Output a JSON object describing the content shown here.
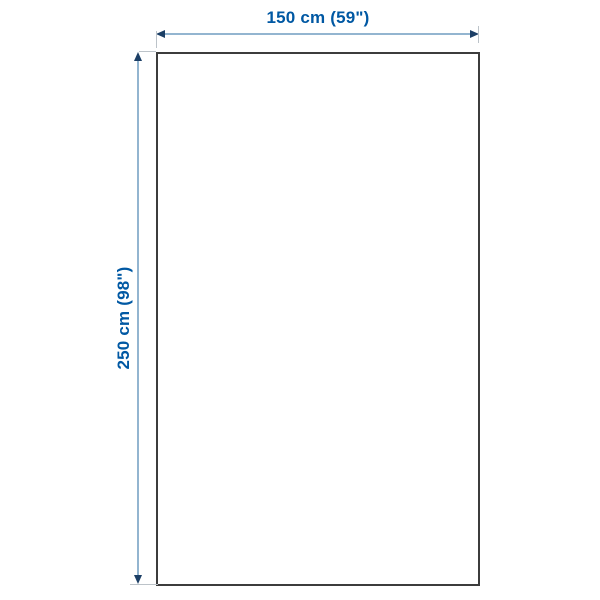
{
  "diagram": {
    "type": "product-dimension-diagram",
    "width_label": "150 cm (59\")",
    "height_label": "250 cm (98\")",
    "width_cm": 150,
    "width_in": 59,
    "height_cm": 250,
    "height_in": 98
  },
  "colors": {
    "background": "#ffffff",
    "label_text": "#0058a3",
    "dimension_line": "#93b5d0",
    "arrowhead": "#1c3f66",
    "extension_tick": "#bcc3c9",
    "outline_border": "#3c3c3c"
  }
}
